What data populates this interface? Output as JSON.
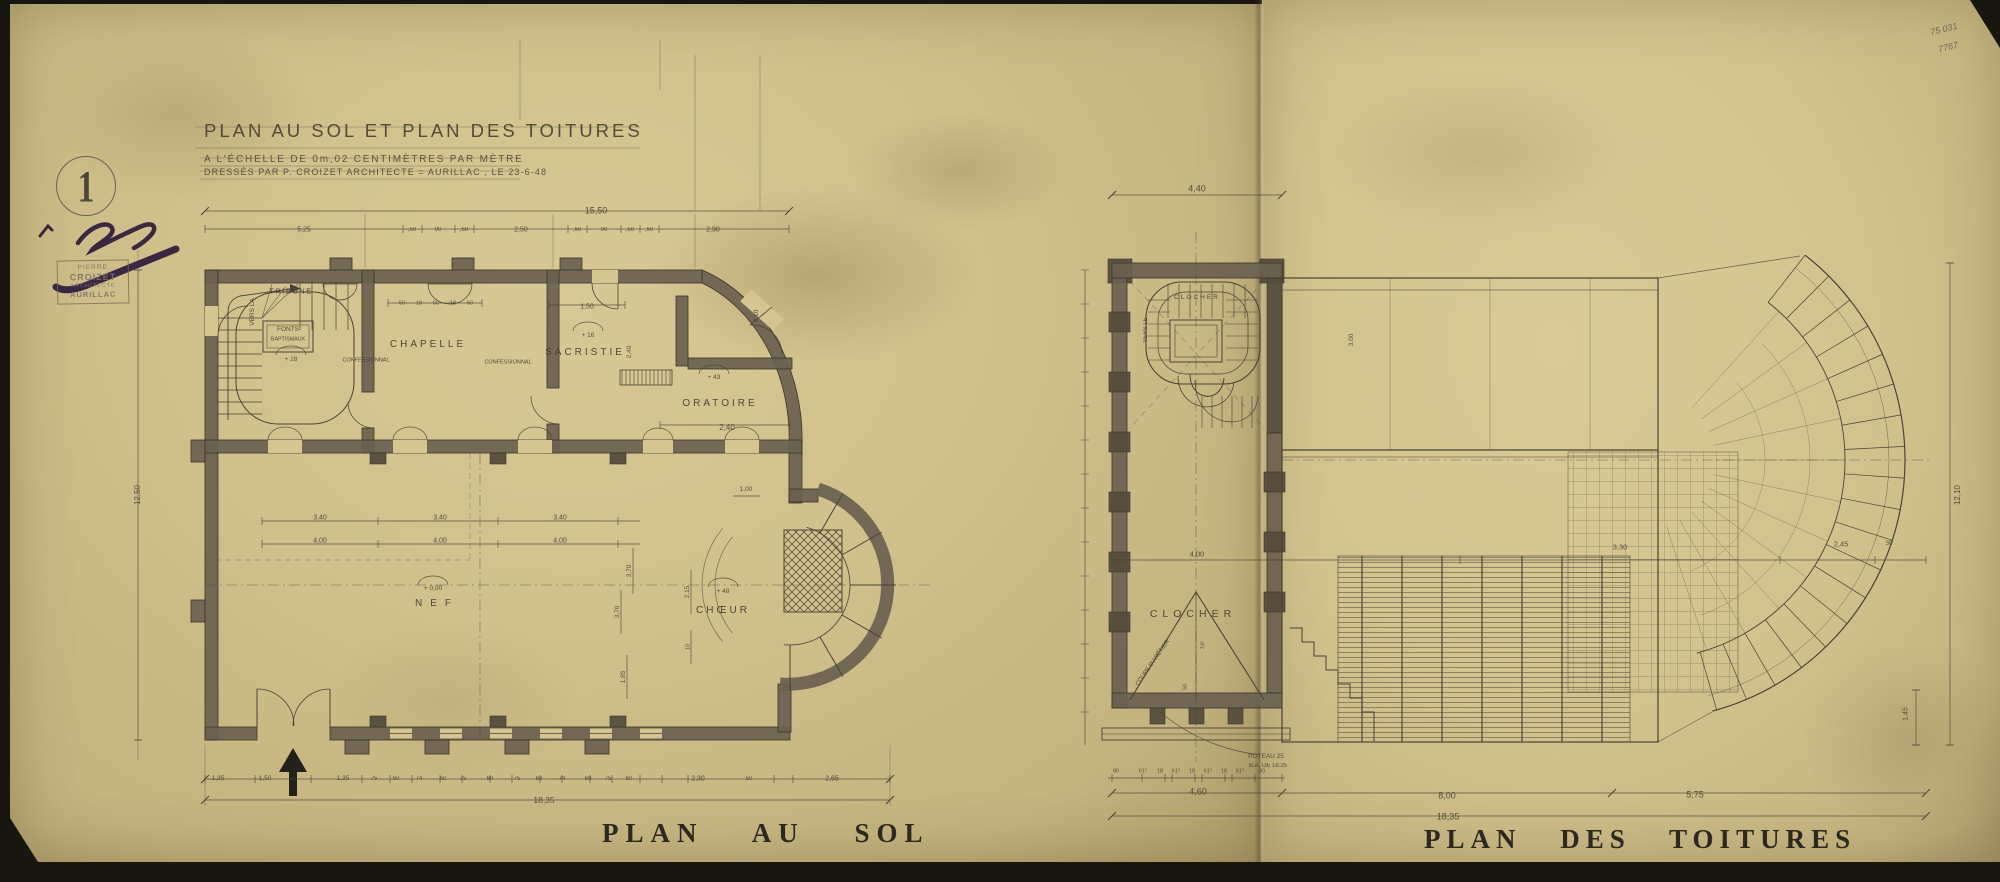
{
  "document": {
    "type": "architectural drawing, aged paper scan",
    "sheet_number": "1"
  },
  "header": {
    "title": "PLAN AU SOL ET PLAN DES TOITURES",
    "scale_line": "A L'ÉCHELLE DE 0m,02 CENTIMÈTRES PAR MÈTRE",
    "credit_line": "DRESSÉS PAR P. CROIZET ARCHITECTE = AURILLAC , LE 23-6-48"
  },
  "stamp": {
    "lines": [
      "PIERRE",
      "CROIZET",
      "ARCHITECTE",
      "AURILLAC"
    ]
  },
  "archive_marks": [
    "75 031",
    "7767"
  ],
  "captions": {
    "left": "PLAN AU SOL",
    "right": "PLAN DES TOITURES"
  },
  "palette": {
    "paper": "#cfc08b",
    "paper_right": "#d2c38e",
    "ink": "#4a4337",
    "wall_poche": "#6a6150",
    "backdrop": "#17160f",
    "stamp_ink": "#7e7263",
    "signature_ink": "#3a2742"
  },
  "ground_plan": {
    "labels": [
      {
        "t": "TRIBUNE",
        "x": 291,
        "y": 291,
        "s": 7.5,
        "ls": 1.5,
        "cl": "room",
        "n": "room-label-tribune"
      },
      {
        "t": "VERS LA",
        "x": 253,
        "y": 312,
        "s": 6.5,
        "r": -90,
        "cl": "room",
        "n": "room-label-vers-la"
      },
      {
        "t": "FONTS",
        "x": 288,
        "y": 330,
        "s": 6.5,
        "cl": "room",
        "n": "room-label-fonts"
      },
      {
        "t": "BAPTISMAUX",
        "x": 288,
        "y": 340,
        "s": 5.3,
        "cl": "room",
        "n": "room-label-baptismaux"
      },
      {
        "t": "+ 28",
        "x": 291,
        "y": 360,
        "s": 6.5,
        "n": "level-mark"
      },
      {
        "t": "CHAPELLE",
        "x": 428,
        "y": 345,
        "s": 10,
        "ls": 3,
        "cl": "room",
        "n": "room-label-chapelle"
      },
      {
        "t": "CONFESSIONNAL",
        "x": 366,
        "y": 361,
        "s": 5.5,
        "cl": "room",
        "n": "room-label-confessionnal"
      },
      {
        "t": "CONFESSIONNAL",
        "x": 508,
        "y": 363,
        "s": 5.5,
        "cl": "room",
        "n": "room-label-confessionnal"
      },
      {
        "t": "SACRISTIE",
        "x": 585,
        "y": 353,
        "s": 10,
        "ls": 3,
        "cl": "room",
        "n": "room-label-sacristie"
      },
      {
        "t": "+ 16",
        "x": 588,
        "y": 336,
        "s": 6.5,
        "n": "level-mark"
      },
      {
        "t": "ORATOIRE",
        "x": 720,
        "y": 404,
        "s": 10,
        "ls": 3,
        "cl": "room",
        "n": "room-label-oratoire"
      },
      {
        "t": "+ 43",
        "x": 714,
        "y": 378,
        "s": 6.5,
        "n": "level-mark"
      },
      {
        "t": "2,40",
        "x": 727,
        "y": 428,
        "s": 8
      },
      {
        "t": "NEF",
        "x": 437,
        "y": 604,
        "s": 10,
        "ls": 8,
        "cl": "room",
        "n": "room-label-nef"
      },
      {
        "t": "+ 0,00",
        "x": 433,
        "y": 589,
        "s": 6.5,
        "n": "level-mark"
      },
      {
        "t": "CHŒUR",
        "x": 723,
        "y": 611,
        "s": 10,
        "ls": 3,
        "cl": "room",
        "n": "room-label-choeur"
      },
      {
        "t": "+ 48",
        "x": 723,
        "y": 592,
        "s": 6.5,
        "n": "level-mark"
      },
      {
        "t": "15,50",
        "x": 596,
        "y": 211,
        "s": 9
      },
      {
        "t": "5,25",
        "x": 304,
        "y": 230,
        "s": 7
      },
      {
        "t": ",50",
        "x": 412,
        "y": 230,
        "s": 6
      },
      {
        "t": "90",
        "x": 438,
        "y": 230,
        "s": 6
      },
      {
        "t": ",50",
        "x": 464,
        "y": 230,
        "s": 6
      },
      {
        "t": "2,50",
        "x": 521,
        "y": 230,
        "s": 7
      },
      {
        "t": ",50",
        "x": 577,
        "y": 230,
        "s": 6
      },
      {
        "t": "90",
        "x": 604,
        "y": 230,
        "s": 6
      },
      {
        "t": ",50",
        "x": 630,
        "y": 230,
        "s": 6
      },
      {
        "t": ",50",
        "x": 649,
        "y": 230,
        "s": 6
      },
      {
        "t": "2,90",
        "x": 713,
        "y": 230,
        "s": 7
      },
      {
        "t": "50",
        "x": 402,
        "y": 304,
        "s": 5.5
      },
      {
        "t": "18",
        "x": 419,
        "y": 304,
        "s": 5.5
      },
      {
        "t": "50",
        "x": 436,
        "y": 304,
        "s": 5.5
      },
      {
        "t": "18",
        "x": 453,
        "y": 304,
        "s": 5.5
      },
      {
        "t": "50",
        "x": 470,
        "y": 304,
        "s": 5.5
      },
      {
        "t": "1,50",
        "x": 587,
        "y": 307,
        "s": 7
      },
      {
        "t": "2,40",
        "x": 630,
        "y": 352,
        "s": 6.5,
        "r": -90
      },
      {
        "t": "1,00",
        "x": 746,
        "y": 490,
        "s": 6.5
      },
      {
        "t": "3,40",
        "x": 320,
        "y": 518,
        "s": 7
      },
      {
        "t": "3,40",
        "x": 440,
        "y": 518,
        "s": 7
      },
      {
        "t": "3,40",
        "x": 560,
        "y": 518,
        "s": 7
      },
      {
        "t": "4,00",
        "x": 320,
        "y": 541,
        "s": 7
      },
      {
        "t": "4,00",
        "x": 440,
        "y": 541,
        "s": 7
      },
      {
        "t": "4,00",
        "x": 560,
        "y": 541,
        "s": 7
      },
      {
        "t": "12,50",
        "x": 138,
        "y": 495,
        "s": 8,
        "r": -90
      },
      {
        "t": "3,70",
        "x": 630,
        "y": 571,
        "s": 6.5,
        "r": -90
      },
      {
        "t": "3,70",
        "x": 618,
        "y": 612,
        "s": 6.5,
        "r": -90
      },
      {
        "t": "2,15",
        "x": 688,
        "y": 592,
        "s": 6.5,
        "r": -90
      },
      {
        "t": "10",
        "x": 689,
        "y": 647,
        "s": 5.5,
        "r": -90
      },
      {
        "t": "1,85",
        "x": 624,
        "y": 677,
        "s": 6.5,
        "r": -90
      },
      {
        "t": "2,10",
        "x": 757,
        "y": 316,
        "s": 6.5,
        "r": -90
      },
      {
        "t": "1,35",
        "x": 218,
        "y": 779,
        "s": 6.5
      },
      {
        "t": "1,50",
        "x": 265,
        "y": 779,
        "s": 6.5
      },
      {
        "t": "1,35",
        "x": 343,
        "y": 779,
        "s": 6.5
      },
      {
        "t": "75",
        "x": 374,
        "y": 779,
        "s": 6
      },
      {
        "t": "60",
        "x": 396,
        "y": 779,
        "s": 6
      },
      {
        "t": "74",
        "x": 419,
        "y": 779,
        "s": 6
      },
      {
        "t": "60",
        "x": 443,
        "y": 779,
        "s": 6
      },
      {
        "t": "75",
        "x": 463,
        "y": 779,
        "s": 6
      },
      {
        "t": "60",
        "x": 490,
        "y": 779,
        "s": 6
      },
      {
        "t": "75",
        "x": 517,
        "y": 779,
        "s": 6
      },
      {
        "t": "60",
        "x": 539,
        "y": 779,
        "s": 6
      },
      {
        "t": "74",
        "x": 562,
        "y": 779,
        "s": 6
      },
      {
        "t": "60",
        "x": 588,
        "y": 779,
        "s": 6
      },
      {
        "t": "75",
        "x": 608,
        "y": 779,
        "s": 6
      },
      {
        "t": "60",
        "x": 629,
        "y": 779,
        "s": 6
      },
      {
        "t": "2,30",
        "x": 698,
        "y": 779,
        "s": 7
      },
      {
        "t": "50",
        "x": 749,
        "y": 779,
        "s": 6
      },
      {
        "t": "2,65",
        "x": 832,
        "y": 779,
        "s": 7
      },
      {
        "t": "18,35",
        "x": 544,
        "y": 800,
        "s": 8.5
      }
    ]
  },
  "roof_plan": {
    "labels": [
      {
        "t": "CLOCHER",
        "x": 1197,
        "y": 298,
        "s": 6.5,
        "ls": 2,
        "cl": "room",
        "n": "room-label-clocher-top"
      },
      {
        "t": "VERS LE",
        "x": 1146,
        "y": 330,
        "s": 6,
        "r": -90,
        "cl": "room",
        "n": "room-label-vers-le"
      },
      {
        "t": "CLOCHER",
        "x": 1193,
        "y": 614,
        "s": 10.5,
        "ls": 5,
        "cl": "room",
        "n": "room-label-clocher"
      },
      {
        "t": "COUPE D'ARÊTIER",
        "x": 1153,
        "y": 663,
        "s": 6,
        "r": -55,
        "cl": "room",
        "n": "note-coupe-aretier"
      },
      {
        "t": "74⁵",
        "x": 1204,
        "y": 645,
        "s": 5.5,
        "r": -90
      },
      {
        "t": "50",
        "x": 1186,
        "y": 687,
        "s": 5.5,
        "r": -90
      },
      {
        "t": "POTEAU 25",
        "x": 1266,
        "y": 757,
        "s": 6.5,
        "n": "note-poteau"
      },
      {
        "t": "B.A. DE 18.25",
        "x": 1268,
        "y": 766,
        "s": 6,
        "n": "note-poteau"
      },
      {
        "t": "4,40",
        "x": 1197,
        "y": 189,
        "s": 9
      },
      {
        "t": "4,00",
        "x": 1197,
        "y": 554,
        "s": 7.5
      },
      {
        "t": "3,30",
        "x": 1620,
        "y": 547,
        "s": 7.5
      },
      {
        "t": "2,45",
        "x": 1841,
        "y": 544,
        "s": 7.5
      },
      {
        "t": "30",
        "x": 1889,
        "y": 544,
        "s": 6.5
      },
      {
        "t": "3,00",
        "x": 1352,
        "y": 340,
        "s": 6.5,
        "r": -90
      },
      {
        "t": "12,10",
        "x": 1958,
        "y": 495,
        "s": 8,
        "r": -90
      },
      {
        "t": "1,45",
        "x": 1906,
        "y": 714,
        "s": 7,
        "r": -90
      },
      {
        "t": "80",
        "x": 1116,
        "y": 772,
        "s": 5.5
      },
      {
        "t": "61⁵",
        "x": 1143,
        "y": 772,
        "s": 5.5
      },
      {
        "t": "18",
        "x": 1160,
        "y": 772,
        "s": 5.5
      },
      {
        "t": "61⁵",
        "x": 1176,
        "y": 772,
        "s": 5.5
      },
      {
        "t": "18",
        "x": 1192,
        "y": 772,
        "s": 5.5
      },
      {
        "t": "61⁵",
        "x": 1208,
        "y": 772,
        "s": 5.5
      },
      {
        "t": "18",
        "x": 1224,
        "y": 772,
        "s": 5.5
      },
      {
        "t": "61⁵",
        "x": 1240,
        "y": 772,
        "s": 5.5
      },
      {
        "t": "80",
        "x": 1262,
        "y": 772,
        "s": 5.5
      },
      {
        "t": "4,60",
        "x": 1198,
        "y": 792,
        "s": 9
      },
      {
        "t": "8,00",
        "x": 1447,
        "y": 796,
        "s": 9
      },
      {
        "t": "5,75",
        "x": 1695,
        "y": 795,
        "s": 9
      },
      {
        "t": "18,35",
        "x": 1448,
        "y": 817,
        "s": 9
      }
    ]
  }
}
